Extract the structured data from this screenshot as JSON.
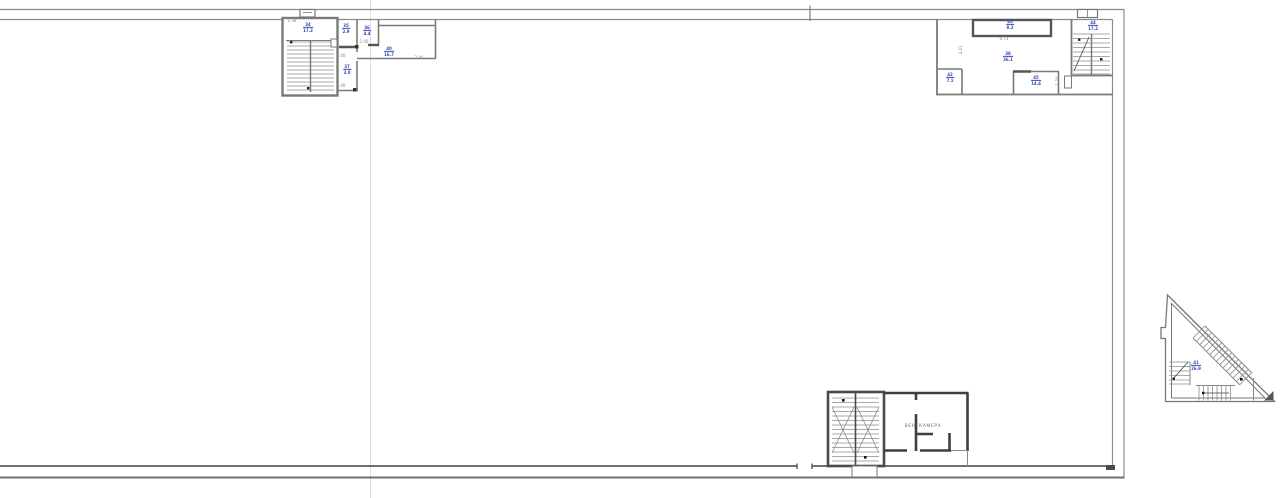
{
  "page": {
    "background": "#ffffff"
  },
  "colors": {
    "wall": "#7f7f7f",
    "wall_dark": "#3f3f3f",
    "room_tag": "#3a47b5",
    "dimension_text": "#8a8a8a",
    "axis_line": "#dcdcdc",
    "vent_label": "#73735c"
  },
  "labels": {
    "vent_room": "ВЕНТКАМЕРА"
  },
  "room_tags": [
    {
      "number": "34",
      "area": "17.2",
      "x": 308,
      "y": 28
    },
    {
      "number": "35",
      "area": "2.9",
      "x": 346,
      "y": 29
    },
    {
      "number": "36",
      "area": "4.4",
      "x": 367,
      "y": 31
    },
    {
      "number": "37",
      "area": "3.0",
      "x": 347,
      "y": 70
    },
    {
      "number": "40",
      "area": "16.7",
      "x": 389,
      "y": 52
    },
    {
      "number": "43",
      "area": "8.2",
      "x": 1010,
      "y": 25
    },
    {
      "number": "38",
      "area": "36.1",
      "x": 1008,
      "y": 57
    },
    {
      "number": "42",
      "area": "7.1",
      "x": 950,
      "y": 78
    },
    {
      "number": "45",
      "area": "14.4",
      "x": 1036,
      "y": 81
    },
    {
      "number": "44",
      "area": "17.2",
      "x": 1093,
      "y": 26
    },
    {
      "number": "41",
      "area": "26.9",
      "x": 1196,
      "y": 366
    }
  ],
  "dim_labels": [
    {
      "text": "2.38",
      "x": 292,
      "y": 21,
      "rot": 0
    },
    {
      "text": "1.40",
      "x": 341,
      "y": 56,
      "rot": 0
    },
    {
      "text": "1.40",
      "x": 341,
      "y": 86,
      "rot": 0
    },
    {
      "text": "2.00",
      "x": 364,
      "y": 42,
      "rot": 0
    },
    {
      "text": "3.40",
      "x": 419,
      "y": 58,
      "rot": 0
    },
    {
      "text": "6.73",
      "x": 1004,
      "y": 39,
      "rot": 0
    },
    {
      "text": "4.41",
      "x": 961,
      "y": 50,
      "rot": -90
    },
    {
      "text": "1.74",
      "x": 1058,
      "y": 81,
      "rot": -90
    }
  ]
}
